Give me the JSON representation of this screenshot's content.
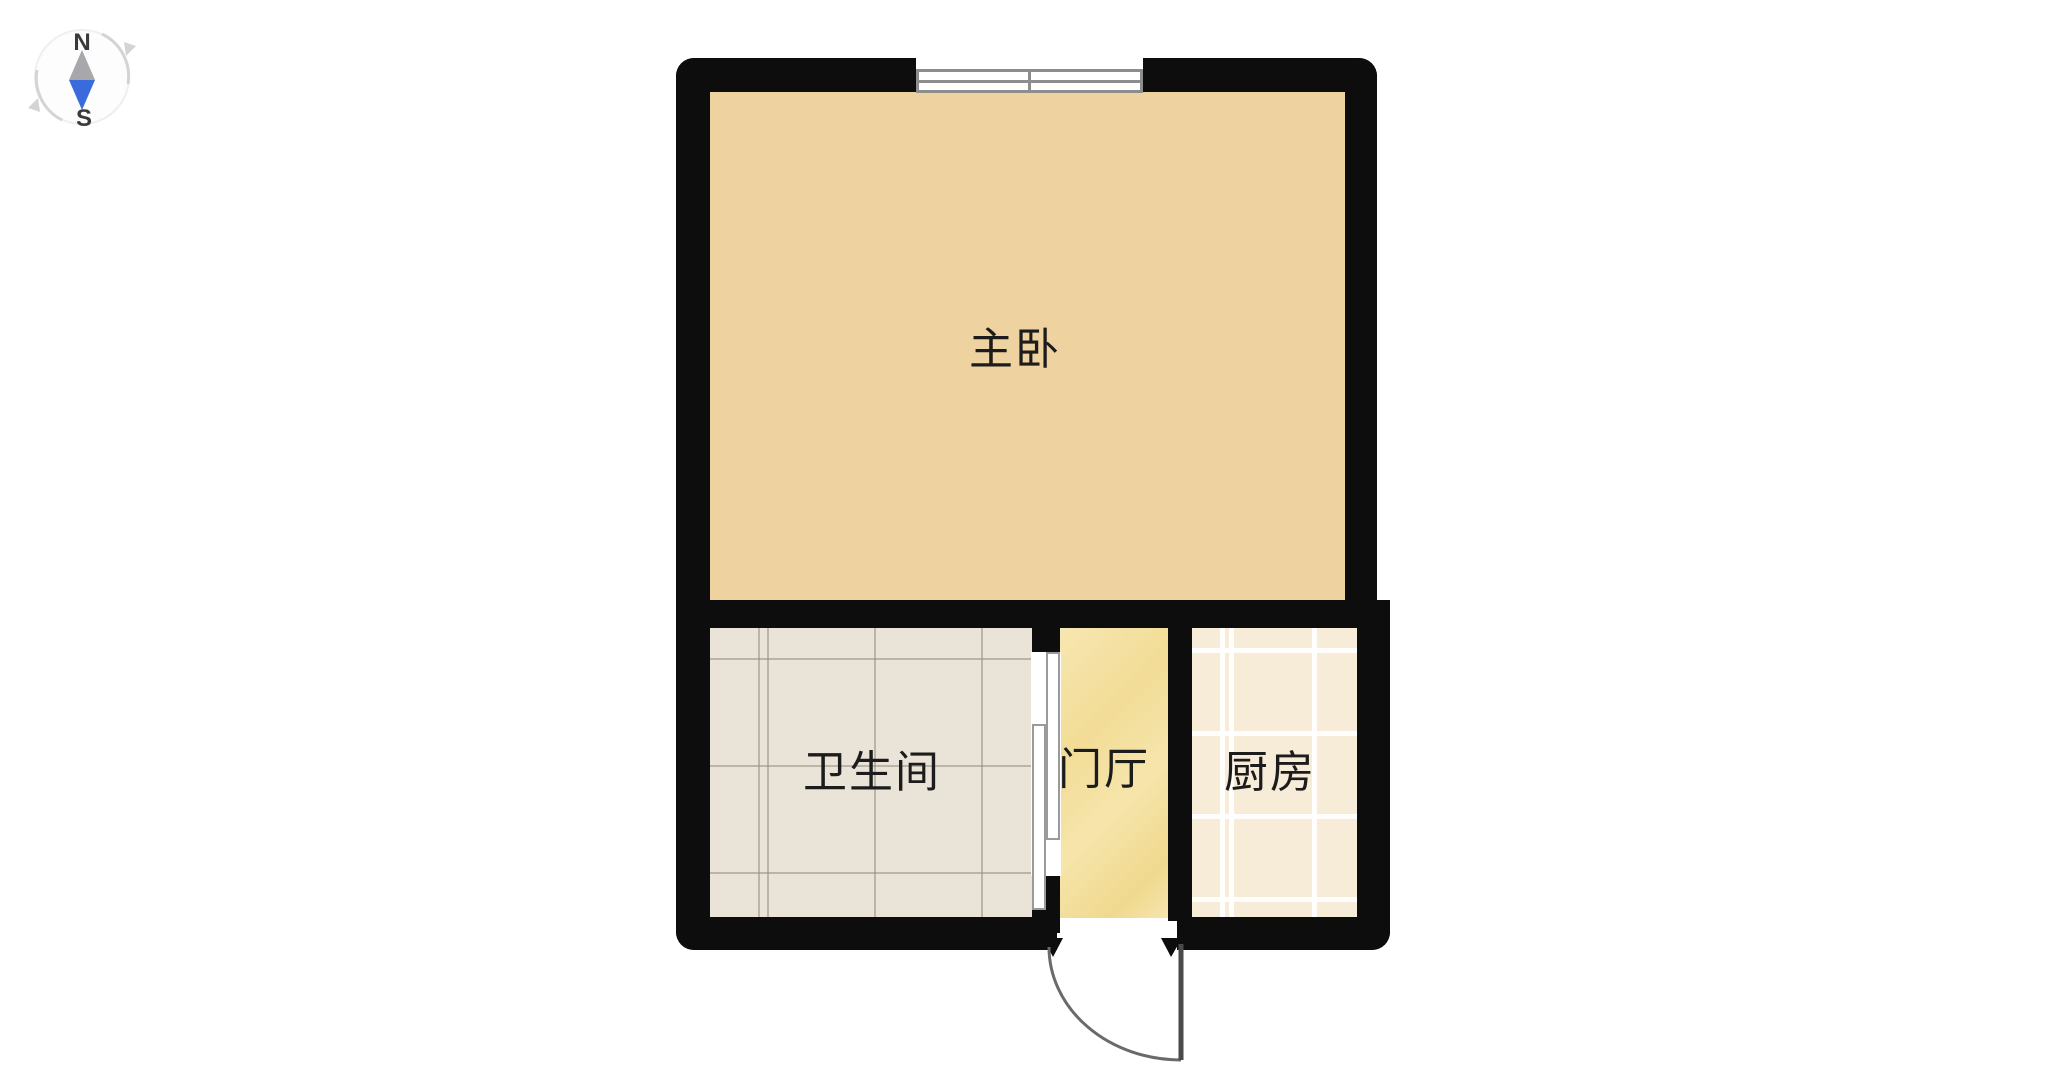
{
  "compass": {
    "north": "N",
    "south": "S",
    "needle_top_color": "#a8a8ac",
    "needle_bottom_color": "#3a6bdc"
  },
  "floorplan": {
    "wall_color": "#0d0d0d",
    "rooms": [
      {
        "name": "master-bedroom",
        "label": "主卧",
        "floor": "wood-plank",
        "floor_color": "#eed3a0"
      },
      {
        "name": "bathroom",
        "label": "卫生间",
        "floor": "stone-tile",
        "floor_color": "#eae4d8"
      },
      {
        "name": "entry-hall",
        "label": "门厅",
        "floor": "marble",
        "floor_color": "#f4e1a2"
      },
      {
        "name": "kitchen",
        "label": "厨房",
        "floor": "ceramic-tile",
        "floor_color": "#f6ecd8"
      }
    ],
    "features": {
      "window": "double-pane-window",
      "entry_door": "swing-door-with-arc",
      "bathroom_door": "sliding-door"
    }
  }
}
